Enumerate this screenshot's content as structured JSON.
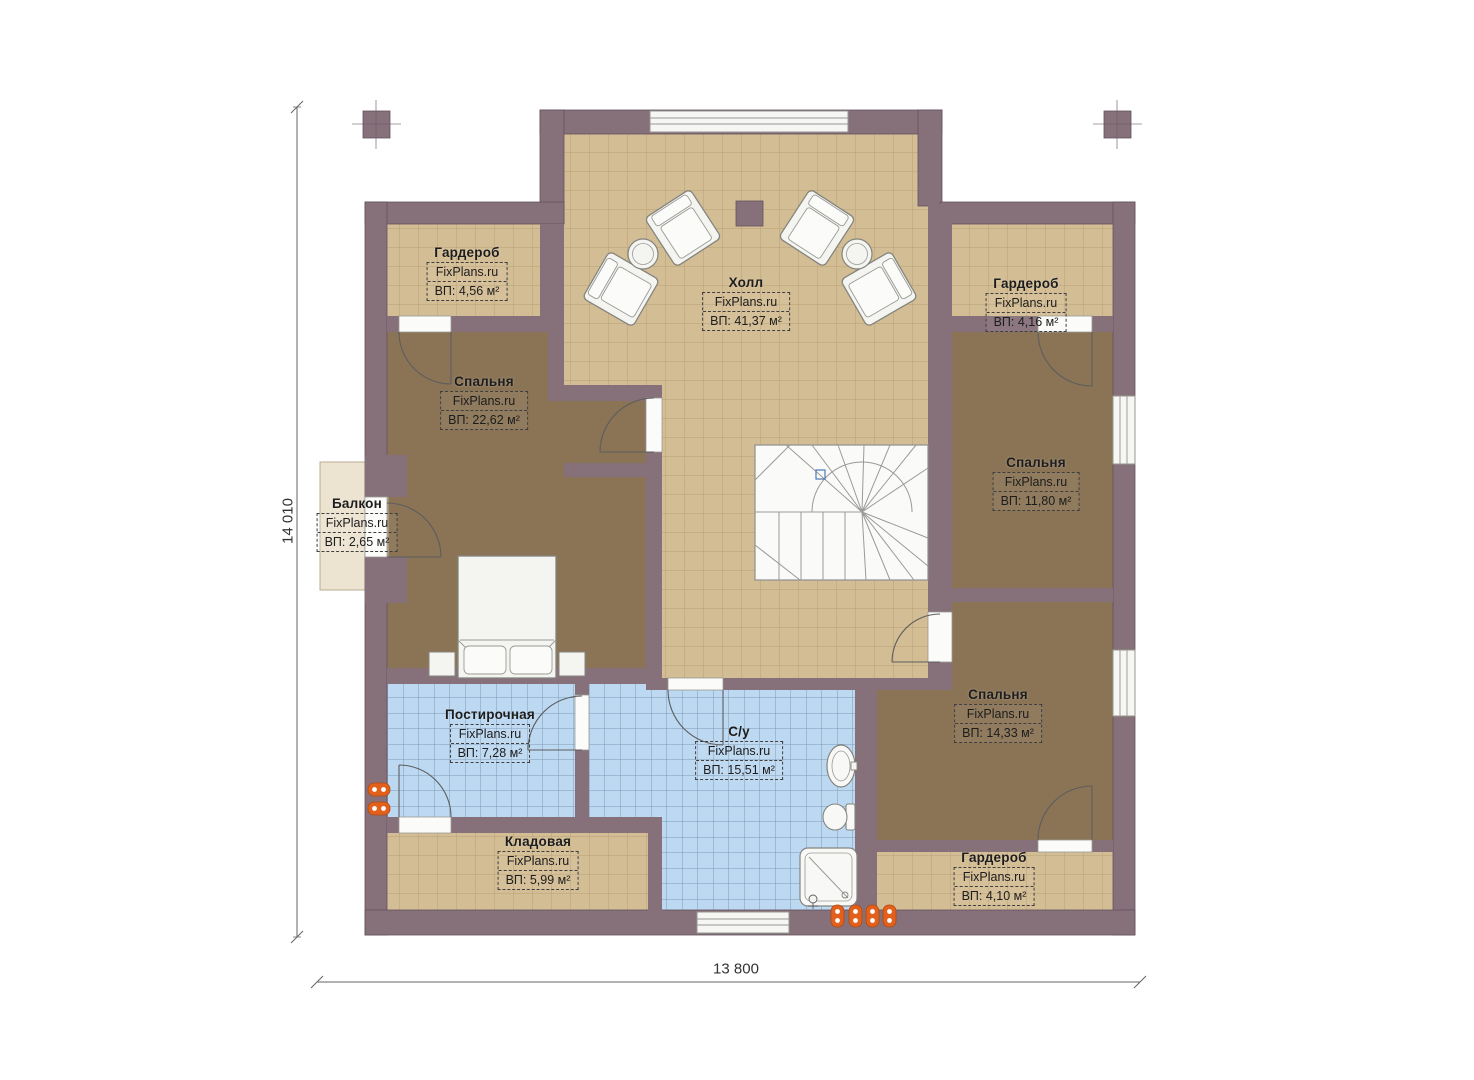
{
  "watermark": "FixPlans.ru",
  "dimensions": {
    "width_label": "13 800",
    "height_label": "14 010"
  },
  "rooms": [
    {
      "id": "wardrobe-top-left",
      "name": "Гардероб",
      "area": "ВП: 4,56 м²"
    },
    {
      "id": "hall",
      "name": "Холл",
      "area": "ВП: 41,37 м²"
    },
    {
      "id": "wardrobe-top-right",
      "name": "Гардероб",
      "area": "ВП: 4,16 м²"
    },
    {
      "id": "bedroom-left",
      "name": "Спальня",
      "area": "ВП: 22,62 м²"
    },
    {
      "id": "bedroom-right",
      "name": "Спальня",
      "area": "ВП: 11,80 м²"
    },
    {
      "id": "balcony",
      "name": "Балкон",
      "area": "ВП: 2,65 м²"
    },
    {
      "id": "bedroom-bottom-right",
      "name": "Спальня",
      "area": "ВП: 14,33 м²"
    },
    {
      "id": "laundry",
      "name": "Постирочная",
      "area": "ВП: 7,28 м²"
    },
    {
      "id": "bathroom",
      "name": "С/у",
      "area": "ВП: 15,51 м²"
    },
    {
      "id": "storage",
      "name": "Кладовая",
      "area": "ВП: 5,99 м²"
    },
    {
      "id": "wardrobe-bottom-right",
      "name": "Гардероб",
      "area": "ВП: 4,10 м²"
    }
  ],
  "colors": {
    "wall": "#86707a",
    "tile_floor": "#d3bd94",
    "carpet_floor": "#8b7456",
    "wet_floor": "#bdd9f2",
    "balcony_floor": "#ece3d1",
    "marker_orange": "#e2601c"
  }
}
